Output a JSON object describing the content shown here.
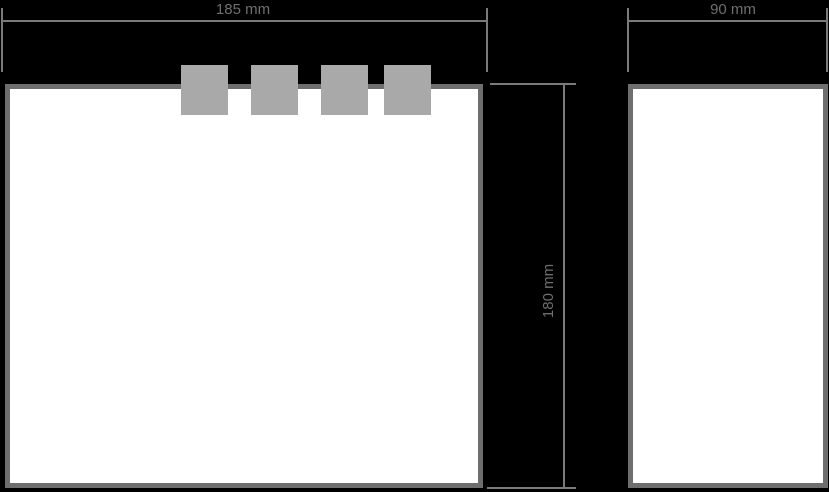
{
  "diagram": {
    "type": "technical-drawing",
    "description": "Two-view dimensioned drawing of a panel with four mounting tabs",
    "colors": {
      "background": "#000000",
      "panel_fill": "#ffffff",
      "panel_border": "#6e6e6e",
      "tab_fill": "#a9a9a9",
      "dimension_line": "#7a7a7a",
      "dimension_text": "#6f6f6f"
    },
    "dimensions": {
      "width_front": {
        "label": "185 mm",
        "value": 185,
        "unit": "mm",
        "orientation": "horizontal"
      },
      "height": {
        "label": "180 mm",
        "value": 180,
        "unit": "mm",
        "orientation": "vertical"
      },
      "width_side": {
        "label": "90 mm",
        "value": 90,
        "unit": "mm",
        "orientation": "horizontal"
      }
    },
    "tabs_count": 4
  }
}
